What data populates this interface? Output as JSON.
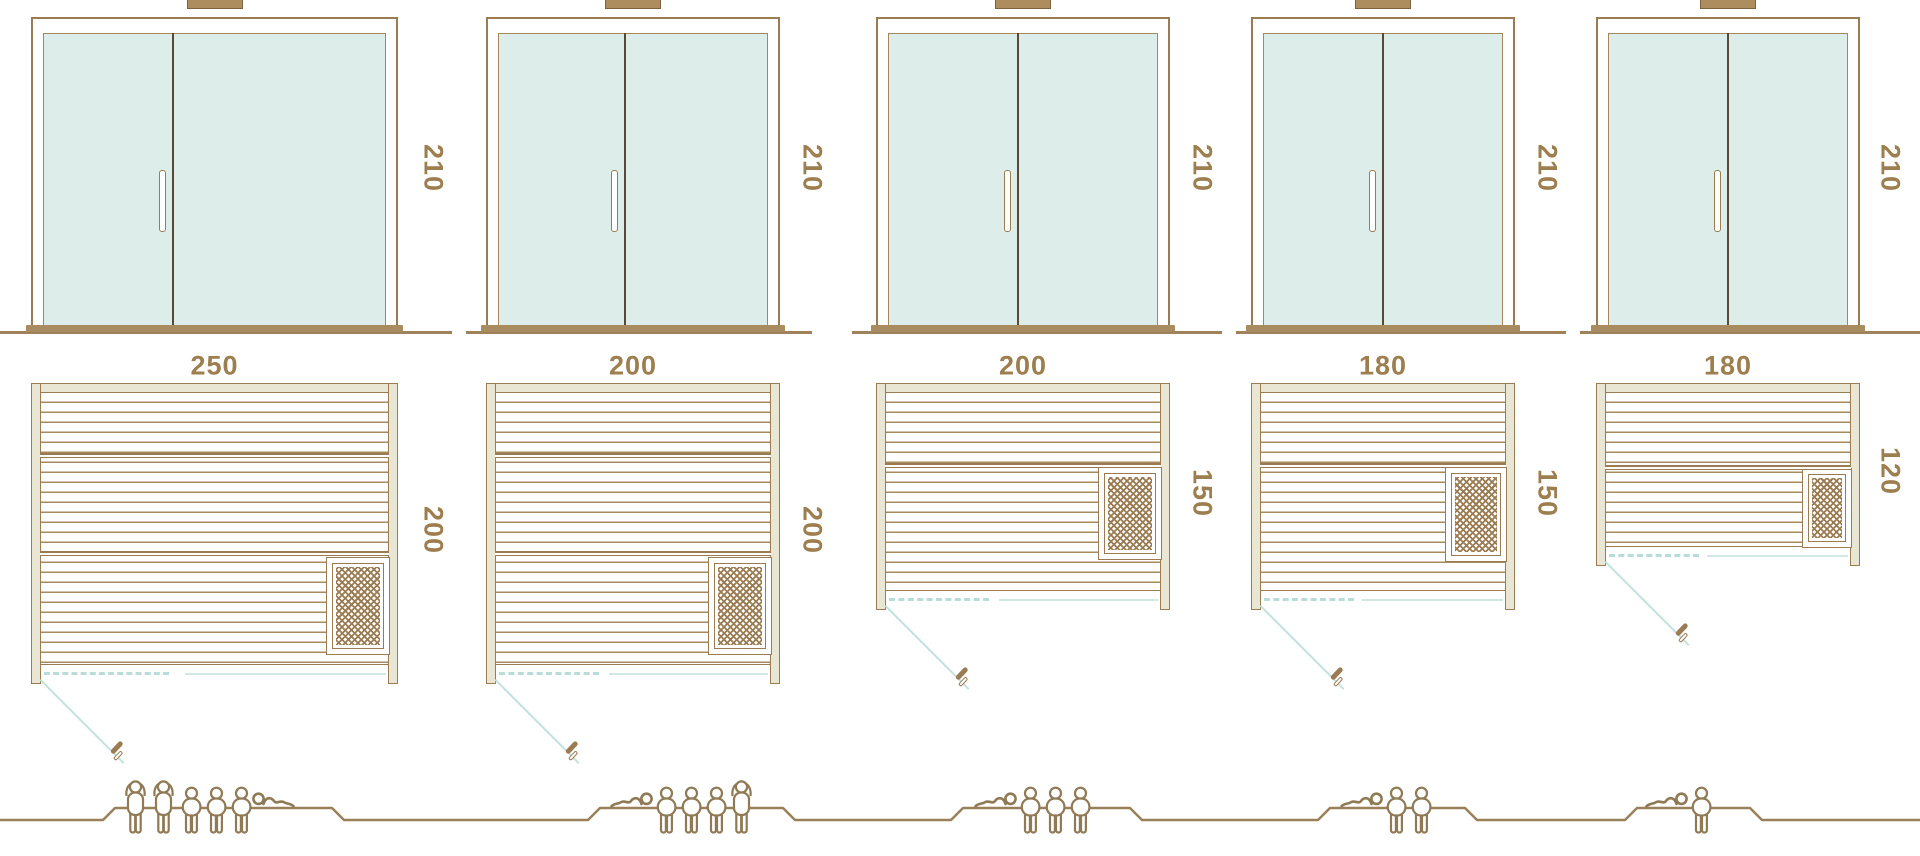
{
  "diagram": {
    "description": "Sauna cabin size comparison: front elevations, floor plans with heater and door swing, and bathing capacity figures",
    "colors": {
      "outline_brown": "#9b7c52",
      "wall_fill": "#e9e6d3",
      "glass_fill": "#dcedea",
      "teal_accent": "#bfe0dc",
      "dimension_text": "#9d7e4e",
      "figure_outline": "#8f7a55"
    },
    "units": [
      {
        "name": "sauna-250x200",
        "front_height_cm": "210",
        "width_cm": "250",
        "depth_cm": "200",
        "capacity": {
          "standing": 2,
          "seated": 3,
          "lying": 1
        },
        "figures": [
          "standing",
          "standing",
          "seated",
          "seated",
          "seated",
          "lying-mirrored"
        ]
      },
      {
        "name": "sauna-200x200",
        "front_height_cm": "210",
        "width_cm": "200",
        "depth_cm": "200",
        "capacity": {
          "standing": 1,
          "seated": 3,
          "lying": 1
        },
        "figures": [
          "lying",
          "seated",
          "seated",
          "seated",
          "standing"
        ]
      },
      {
        "name": "sauna-200x150",
        "front_height_cm": "210",
        "width_cm": "200",
        "depth_cm": "150",
        "capacity": {
          "standing": 0,
          "seated": 3,
          "lying": 1
        },
        "figures": [
          "lying",
          "seated",
          "seated",
          "seated"
        ]
      },
      {
        "name": "sauna-180x150",
        "front_height_cm": "210",
        "width_cm": "180",
        "depth_cm": "150",
        "capacity": {
          "standing": 0,
          "seated": 2,
          "lying": 1
        },
        "figures": [
          "lying",
          "seated",
          "seated"
        ]
      },
      {
        "name": "sauna-180x120",
        "front_height_cm": "210",
        "width_cm": "180",
        "depth_cm": "120",
        "capacity": {
          "standing": 0,
          "seated": 1,
          "lying": 1
        },
        "figures": [
          "lying",
          "seated"
        ]
      }
    ]
  }
}
